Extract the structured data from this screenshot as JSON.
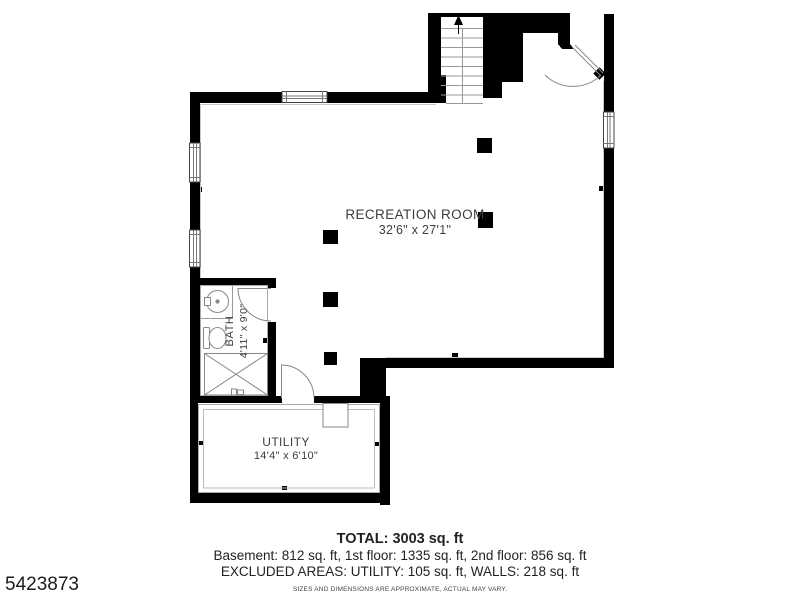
{
  "plan": {
    "id_number": "5423873",
    "rooms": [
      {
        "name": "RECREATION ROOM",
        "dimensions": "32'6\" x 27'1\""
      },
      {
        "name": "BATH",
        "dimensions": "4'11\" x 9'0\""
      },
      {
        "name": "UTILITY",
        "dimensions": "14'4\" x 6'10\""
      }
    ],
    "footer": {
      "total": "TOTAL: 3003 sq. ft",
      "floors": "Basement: 812 sq. ft, 1st floor: 1335 sq. ft, 2nd floor: 856 sq. ft",
      "excluded": "EXCLUDED AREAS: UTILITY: 105 sq. ft, WALLS: 218 sq. ft",
      "disclaimer": "SIZES AND DIMENSIONS ARE APPROXIMATE, ACTUAL MAY VARY."
    },
    "colors": {
      "wall": "#000000",
      "thin_line": "#999999",
      "light_line": "#c8c8c8",
      "text": "#3d3d3d",
      "footer_text": "#222222"
    }
  }
}
